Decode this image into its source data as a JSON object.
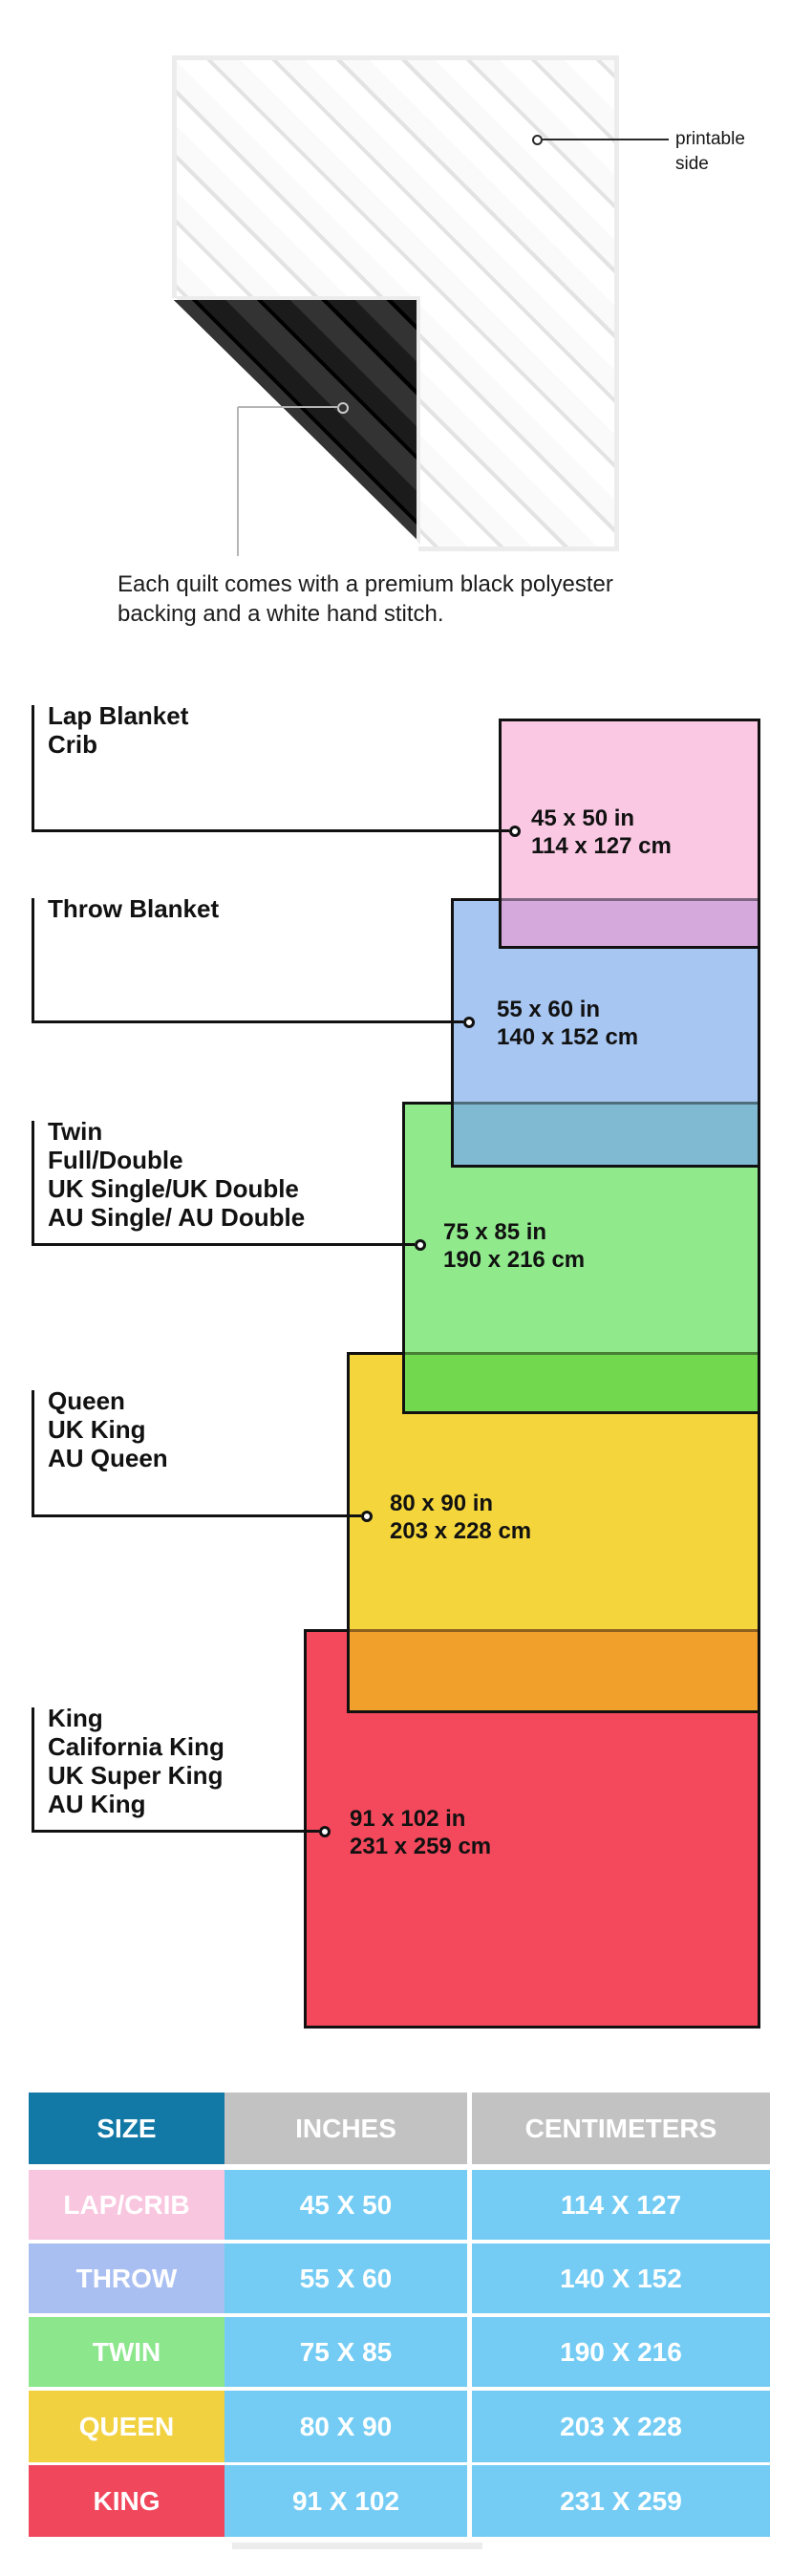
{
  "quilt_note": {
    "printable_lines": [
      "printable",
      "side"
    ],
    "caption_lines": [
      "Each quilt comes with a premium black polyester",
      "backing and a white hand stitch."
    ]
  },
  "diagram": {
    "border_color": "#111111",
    "groups": [
      {
        "name": "lap-crib",
        "labels": [
          "Lap Blanket",
          "Crib"
        ],
        "inches": "45 x 50 in",
        "centimeters": "114 x 127 cm",
        "fill": "#FAC8E3"
      },
      {
        "name": "throw",
        "labels": [
          "Throw Blanket"
        ],
        "inches": "55 x 60 in",
        "centimeters": "140 x 152 cm",
        "fill": "#A8C6F2"
      },
      {
        "name": "twin",
        "labels": [
          "Twin",
          "Full/Double",
          "UK Single/UK Double",
          "AU Single/ AU Double"
        ],
        "inches": "75 x 85 in",
        "centimeters": "190 x 216 cm",
        "fill": "#90EA8C"
      },
      {
        "name": "queen",
        "labels": [
          "Queen",
          "UK King",
          "AU Queen"
        ],
        "inches": "80 x 90 in",
        "centimeters": "203 x 228 cm",
        "fill": "#F4D63C"
      },
      {
        "name": "king",
        "labels": [
          "King",
          "California King",
          "UK Super King",
          "AU King"
        ],
        "inches": "91 x 102 in",
        "centimeters": "231 x 259 cm",
        "fill": "#F4495C"
      }
    ],
    "overlap_fills": {
      "pink_over_blue": "#D5A9DC",
      "blue_over_green": "#80B9D2",
      "green_over_yellow": "#72D94F",
      "yellow_over_red": "#F2A02C"
    }
  },
  "table": {
    "headers": [
      "SIZE",
      "INCHES",
      "CENTIMETERS"
    ],
    "header_colors": {
      "size": "#1278A6",
      "measure": "#C2C2C2"
    },
    "value_cell_color": "#74CCF4",
    "rows": [
      {
        "size": "LAP/CRIB",
        "inches": "45 X 50",
        "centimeters": "114 X 127",
        "fill": "#F9C6DF"
      },
      {
        "size": "THROW",
        "inches": "55 X 60",
        "centimeters": "140 X 152",
        "fill": "#A9BFF2"
      },
      {
        "size": "TWIN",
        "inches": "75 X 85",
        "centimeters": "190 X 216",
        "fill": "#8CE68C"
      },
      {
        "size": "QUEEN",
        "inches": "80 X 90",
        "centimeters": "203 X 228",
        "fill": "#F2D140"
      },
      {
        "size": "KING",
        "inches": "91 X 102",
        "centimeters": "231 X 259",
        "fill": "#F0475C"
      }
    ]
  }
}
